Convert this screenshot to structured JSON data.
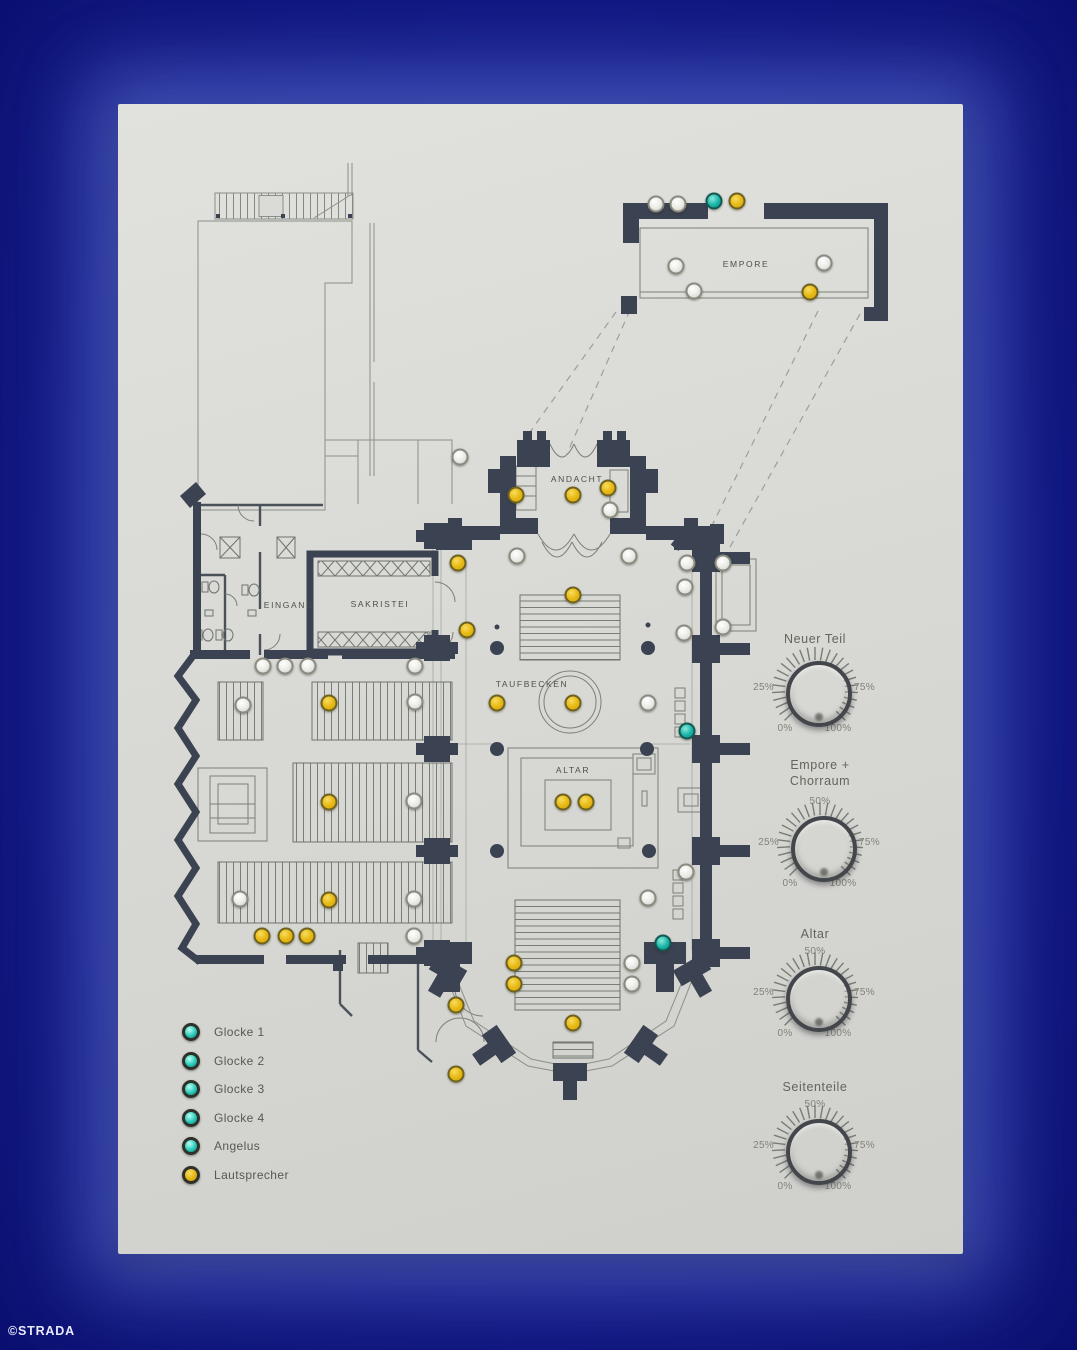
{
  "watermark": "©STRADA",
  "colors": {
    "background": "#0e1480",
    "panel": "#d9d9d5",
    "wall": "#3b4252",
    "led_yellow": "#e9bb17",
    "led_teal": "#16b4a6",
    "led_white": "#eaeae5"
  },
  "floor_plan": {
    "rooms": {
      "empore": "EMPORE",
      "andacht": "ANDACHT",
      "eingang": "EINGANG",
      "sakristei": "SAKRISTEI",
      "taufbecken": "TAUFBECKEN",
      "altar": "ALTAR"
    },
    "leds": [
      {
        "x": 538,
        "y": 100,
        "type": "white"
      },
      {
        "x": 560,
        "y": 100,
        "type": "white"
      },
      {
        "x": 596,
        "y": 97,
        "type": "teal"
      },
      {
        "x": 619,
        "y": 97,
        "type": "yellow"
      },
      {
        "x": 558,
        "y": 162,
        "type": "white"
      },
      {
        "x": 576,
        "y": 187,
        "type": "white"
      },
      {
        "x": 706,
        "y": 159,
        "type": "white"
      },
      {
        "x": 692,
        "y": 188,
        "type": "yellow"
      },
      {
        "x": 342,
        "y": 353,
        "type": "white"
      },
      {
        "x": 398,
        "y": 391,
        "type": "yellow"
      },
      {
        "x": 455,
        "y": 391,
        "type": "yellow"
      },
      {
        "x": 490,
        "y": 384,
        "type": "yellow"
      },
      {
        "x": 492,
        "y": 406,
        "type": "white"
      },
      {
        "x": 399,
        "y": 452,
        "type": "white"
      },
      {
        "x": 511,
        "y": 452,
        "type": "white"
      },
      {
        "x": 340,
        "y": 459,
        "type": "yellow"
      },
      {
        "x": 349,
        "y": 526,
        "type": "yellow"
      },
      {
        "x": 455,
        "y": 491,
        "type": "yellow"
      },
      {
        "x": 145,
        "y": 562,
        "type": "white"
      },
      {
        "x": 167,
        "y": 562,
        "type": "white"
      },
      {
        "x": 190,
        "y": 562,
        "type": "white"
      },
      {
        "x": 297,
        "y": 562,
        "type": "white"
      },
      {
        "x": 125,
        "y": 601,
        "type": "white"
      },
      {
        "x": 211,
        "y": 599,
        "type": "yellow"
      },
      {
        "x": 297,
        "y": 598,
        "type": "white"
      },
      {
        "x": 211,
        "y": 698,
        "type": "yellow"
      },
      {
        "x": 296,
        "y": 697,
        "type": "white"
      },
      {
        "x": 122,
        "y": 795,
        "type": "white"
      },
      {
        "x": 211,
        "y": 796,
        "type": "yellow"
      },
      {
        "x": 296,
        "y": 795,
        "type": "white"
      },
      {
        "x": 144,
        "y": 832,
        "type": "yellow"
      },
      {
        "x": 168,
        "y": 832,
        "type": "yellow"
      },
      {
        "x": 189,
        "y": 832,
        "type": "yellow"
      },
      {
        "x": 296,
        "y": 832,
        "type": "white"
      },
      {
        "x": 379,
        "y": 599,
        "type": "yellow"
      },
      {
        "x": 455,
        "y": 599,
        "type": "yellow"
      },
      {
        "x": 530,
        "y": 599,
        "type": "white"
      },
      {
        "x": 569,
        "y": 627,
        "type": "teal"
      },
      {
        "x": 445,
        "y": 698,
        "type": "yellow"
      },
      {
        "x": 468,
        "y": 698,
        "type": "yellow"
      },
      {
        "x": 569,
        "y": 459,
        "type": "white"
      },
      {
        "x": 605,
        "y": 459,
        "type": "white"
      },
      {
        "x": 567,
        "y": 483,
        "type": "white"
      },
      {
        "x": 566,
        "y": 529,
        "type": "white"
      },
      {
        "x": 605,
        "y": 523,
        "type": "white"
      },
      {
        "x": 568,
        "y": 768,
        "type": "white"
      },
      {
        "x": 530,
        "y": 794,
        "type": "white"
      },
      {
        "x": 396,
        "y": 859,
        "type": "yellow"
      },
      {
        "x": 396,
        "y": 880,
        "type": "yellow"
      },
      {
        "x": 514,
        "y": 859,
        "type": "white"
      },
      {
        "x": 514,
        "y": 880,
        "type": "white"
      },
      {
        "x": 545,
        "y": 839,
        "type": "teal"
      },
      {
        "x": 338,
        "y": 901,
        "type": "yellow"
      },
      {
        "x": 455,
        "y": 919,
        "type": "yellow"
      },
      {
        "x": 338,
        "y": 970,
        "type": "yellow"
      }
    ]
  },
  "legend": {
    "items": [
      {
        "label": "Glocke 1",
        "type": "teal"
      },
      {
        "label": "Glocke 2",
        "type": "teal"
      },
      {
        "label": "Glocke 3",
        "type": "teal"
      },
      {
        "label": "Glocke 4",
        "type": "teal"
      },
      {
        "label": "Angelus",
        "type": "teal"
      },
      {
        "label": "Lautsprecher",
        "type": "yellow"
      }
    ]
  },
  "knobs": [
    {
      "title": "Neuer Teil",
      "labels": {
        "p25": "25%",
        "p75": "75%",
        "p0": "0%",
        "p100": "100%"
      }
    },
    {
      "title": "Empore +",
      "title2": "Chorraum",
      "labels": {
        "p50": "50%",
        "p25": "25%",
        "p75": "75%",
        "p0": "0%",
        "p100": "100%"
      }
    },
    {
      "title": "Altar",
      "labels": {
        "p50": "50%",
        "p25": "25%",
        "p75": "75%",
        "p0": "0%",
        "p100": "100%"
      }
    },
    {
      "title": "Seitenteile",
      "labels": {
        "p50": "50%",
        "p25": "25%",
        "p75": "75%",
        "p0": "0%",
        "p100": "100%"
      }
    }
  ]
}
